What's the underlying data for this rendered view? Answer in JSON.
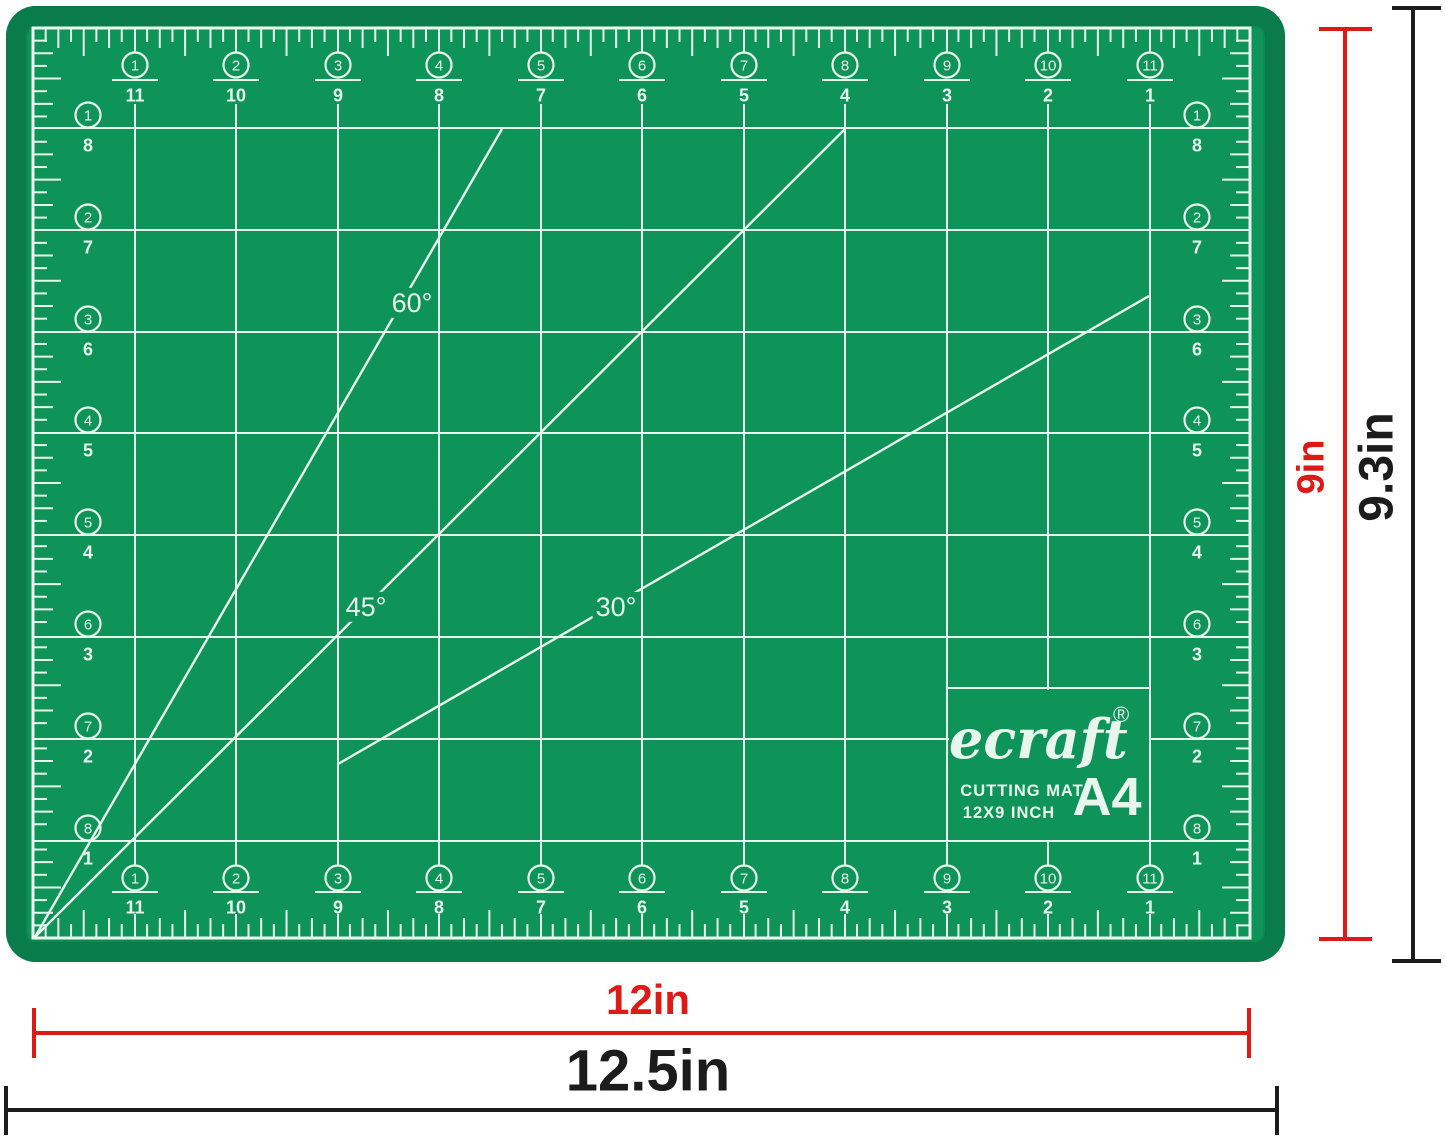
{
  "figure": {
    "background": "#FFFFFF"
  },
  "mat": {
    "surface_color": "#0E9459",
    "rim_color": "#0A7B4B",
    "line_color": "#E9F6EE",
    "rulers": {
      "top": {
        "circled": [
          "1",
          "2",
          "3",
          "4",
          "5",
          "6",
          "7",
          "8",
          "9",
          "10",
          "11"
        ],
        "digits": [
          "11",
          "10",
          "9",
          "8",
          "7",
          "6",
          "5",
          "4",
          "3",
          "2",
          "1"
        ]
      },
      "bottom": {
        "circled": [
          "1",
          "2",
          "3",
          "4",
          "5",
          "6",
          "7",
          "8",
          "9",
          "10",
          "11"
        ],
        "digits": [
          "11",
          "10",
          "9",
          "8",
          "7",
          "6",
          "5",
          "4",
          "3",
          "2",
          "1"
        ]
      },
      "left": {
        "circled": [
          "1",
          "2",
          "3",
          "4",
          "5",
          "6",
          "7",
          "8"
        ],
        "digits": [
          "8",
          "7",
          "6",
          "5",
          "4",
          "3",
          "2",
          "1"
        ]
      },
      "right": {
        "circled": [
          "1",
          "2",
          "3",
          "4",
          "5",
          "6",
          "7",
          "8"
        ],
        "digits": [
          "8",
          "7",
          "6",
          "5",
          "4",
          "3",
          "2",
          "1"
        ]
      }
    },
    "angle_labels": {
      "sixty": "60°",
      "fortyfive": "45°",
      "thirty": "30°"
    },
    "logo": {
      "brand": "ecraft",
      "registered": "®",
      "line1": "CUTTING MAT",
      "line2": "12X9 INCH",
      "badge": "A4"
    }
  },
  "dimensions": {
    "grid_width": {
      "label": "12in",
      "color": "#DE1A18"
    },
    "total_width": {
      "label": "12.5in",
      "color": "#1C1C1C"
    },
    "grid_height": {
      "label": "9in",
      "color": "#DE1A18"
    },
    "total_height": {
      "label": "9.3in",
      "color": "#1C1C1C"
    }
  }
}
